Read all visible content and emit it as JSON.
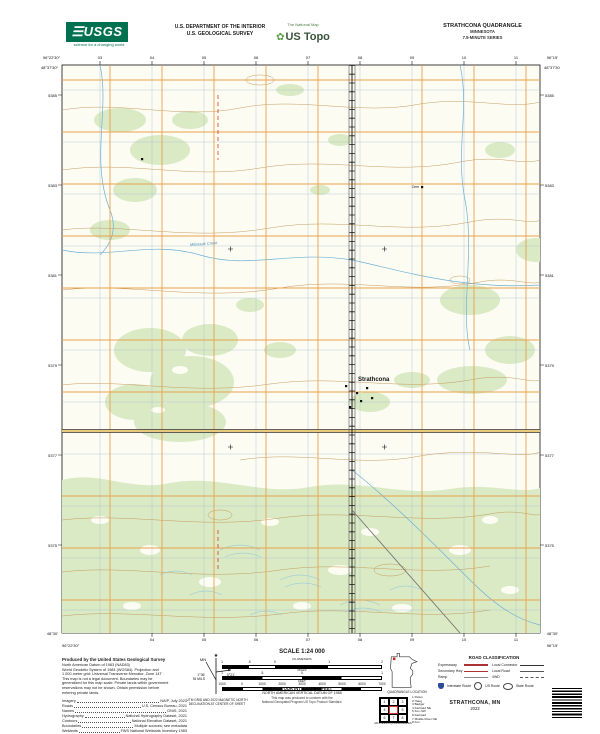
{
  "header": {
    "usgs": {
      "name": "USGS",
      "tagline": "science for a changing world"
    },
    "dept_line1": "U.S. DEPARTMENT OF THE INTERIOR",
    "dept_line2": "U.S. GEOLOGICAL SURVEY",
    "ustopo_brand": "US Topo",
    "ustopo_tagline": "The National Map",
    "quad_title": "STRATHCONA QUADRANGLE",
    "quad_state": "MINNESOTA",
    "quad_series": "7.5-MINUTE SERIES"
  },
  "map": {
    "town_label": "Strathcona",
    "creek_label": "Mikinaak Creek",
    "cem_label": "Cem",
    "corners": {
      "tl_lat": "48°37′30″",
      "tl_lon": "96°22′30″",
      "tr_lat": "48°37′30″",
      "tr_lon": "96°15′",
      "bl_lat": "48°30′",
      "bl_lon": "96°22′30″",
      "br_lat": "48°30′",
      "br_lon": "96°15′"
    },
    "top_ticks": [
      "03",
      "04",
      "05",
      "06",
      "07",
      "08",
      "09",
      "10",
      "11"
    ],
    "bottom_ticks": [
      "04",
      "05",
      "06",
      "07",
      "08",
      "09",
      "10",
      "11"
    ],
    "left_ticks": [
      "5385",
      "5383",
      "5381",
      "5379",
      "5377",
      "5375"
    ],
    "right_ticks": [
      "5385",
      "5383",
      "5381",
      "5379",
      "5377",
      "5375"
    ]
  },
  "footer": {
    "produced_by": "Produced by the United States Geological Survey",
    "metadata_lines": [
      "North American Datum of 1983 (NAD83)",
      "World Geodetic System of 1984 (WGS84). Projection and",
      "1 000-meter grid: Universal Transverse Mercator, Zone 14T",
      "This map is not a legal document. Boundaries may be",
      "generalized for this map scale. Private lands within government",
      "reservations may not be shown. Obtain permission before",
      "entering private lands."
    ],
    "credits": [
      {
        "label": "Imagery",
        "value": "NAIP, July 2021"
      },
      {
        "label": "Roads",
        "value": "U.S. Census Bureau, 2021"
      },
      {
        "label": "Names",
        "value": "GNIS, 2021"
      },
      {
        "label": "Hydrography",
        "value": "National Hydrography Dataset, 2021"
      },
      {
        "label": "Contours",
        "value": "National Elevation Dataset, 2021"
      },
      {
        "label": "Boundaries",
        "value": "Multiple sources; see metadata"
      },
      {
        "label": "Wetlands",
        "value": "FWS National Wetlands Inventory 1983"
      }
    ],
    "declination": {
      "star": "★",
      "gn": "GN",
      "mn": "MN",
      "gn_value": "0°21′",
      "gn_mils": "6 MILS",
      "mn_value": "1°36′",
      "mn_mils": "28 MILS",
      "caption1": "UTM GRID AND 2022 MAGNETIC NORTH",
      "caption2": "DECLINATION AT CENTER OF SHEET"
    },
    "scale": {
      "title": "SCALE 1:24 000",
      "bars": [
        {
          "unit": "KILOMETERS",
          "ticks": [
            "1",
            ".5",
            "0",
            "1",
            "2"
          ]
        },
        {
          "unit": "MILES",
          "ticks": [
            "1",
            ".5",
            "0",
            "1"
          ]
        },
        {
          "unit": "FEET",
          "ticks": [
            "1000",
            "0",
            "1000",
            "2000",
            "3000",
            "4000",
            "5000",
            "6000",
            "7000"
          ]
        }
      ]
    },
    "contour_line1": "CONTOUR INTERVAL 10 FEET",
    "contour_line2": "NORTH AMERICAN VERTICAL DATUM OF 1988",
    "standard_line1": "This map was produced to conform with the",
    "standard_line2": "National Geospatial Program US Topo Product Standard.",
    "quad_location_caption": "QUADRANGLE LOCATION",
    "adjoining_caption": "ADJOINING QUADRANGLES",
    "adjoining_cells": [
      "1",
      "2",
      "3",
      "4",
      "5",
      "6",
      "7",
      "8"
    ],
    "adjoining_list": [
      "1 Pelan",
      "2 Haug",
      "3 Badger",
      "4 Karlstad NE",
      "5 Fox NW",
      "6 Karlstad",
      "7 Middle River NE",
      "8 Fox"
    ],
    "road_class": {
      "title": "ROAD CLASSIFICATION",
      "rows": [
        {
          "left": "Expressway",
          "right": "Local Connector"
        },
        {
          "left": "Secondary Hwy",
          "right": "Local Road"
        },
        {
          "left": "Ramp",
          "right": "4WD"
        }
      ],
      "shields": [
        "Interstate Route",
        "US Route",
        "State Route"
      ]
    },
    "map_title": "STRATHCONA, MN",
    "map_year": "2022"
  },
  "colors": {
    "usgs_green": "#007150",
    "vegetation": "#d9eac4",
    "contour_brown": "#c79b5e",
    "water_blue": "#6fb0d4",
    "road_orange": "#e8a14e",
    "boundary_red": "#d23b2a"
  }
}
